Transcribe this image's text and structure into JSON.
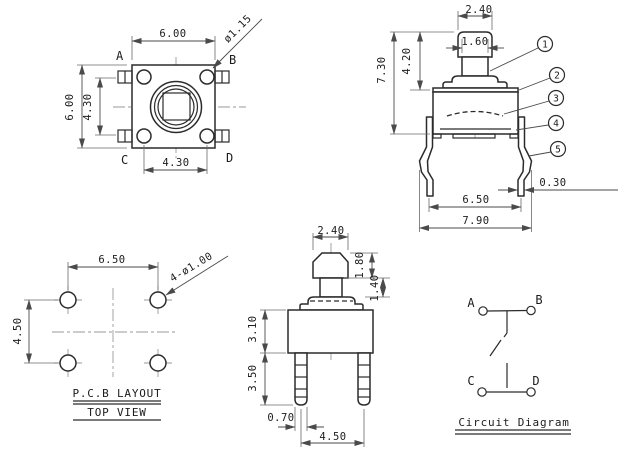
{
  "views": {
    "top": {
      "dims": {
        "width": "6.00",
        "height": "6.00",
        "pin_span_v": "4.30",
        "pin_span_h": "4.30",
        "pin_dia": "ø1.15"
      },
      "terminals": {
        "a": "A",
        "b": "B",
        "c": "C",
        "d": "D"
      }
    },
    "side": {
      "dims": {
        "cap_width": "2.40",
        "stem_width": "1.60",
        "actuator_height": "4.20",
        "total_height": "7.30",
        "leg_span": "6.50",
        "overall_width": "7.90",
        "leg_thickness": "0.30"
      },
      "callouts": {
        "c1": "1",
        "c2": "2",
        "c3": "3",
        "c4": "4",
        "c5": "5"
      }
    },
    "pcb": {
      "dims": {
        "hole_span_h": "6.50",
        "hole_span_v": "4.50",
        "hole_note": "4-ø1.00"
      },
      "caption_line1": "P.C.B LAYOUT",
      "caption_line2": "TOP VIEW"
    },
    "front": {
      "dims": {
        "cap_width": "2.40",
        "cap_height": "1.80",
        "stem_height": "1.40",
        "body_height": "3.10",
        "leg_length": "3.50",
        "leg_width": "0.70",
        "leg_span": "4.50"
      }
    },
    "circuit": {
      "terminals": {
        "a": "A",
        "b": "B",
        "c": "C",
        "d": "D"
      },
      "caption": "Circuit Diagram"
    }
  },
  "colors": {
    "line": "#2b2b2b",
    "dimension": "#4a4a4a",
    "centerline": "#9a9a9a",
    "background": "#ffffff"
  }
}
